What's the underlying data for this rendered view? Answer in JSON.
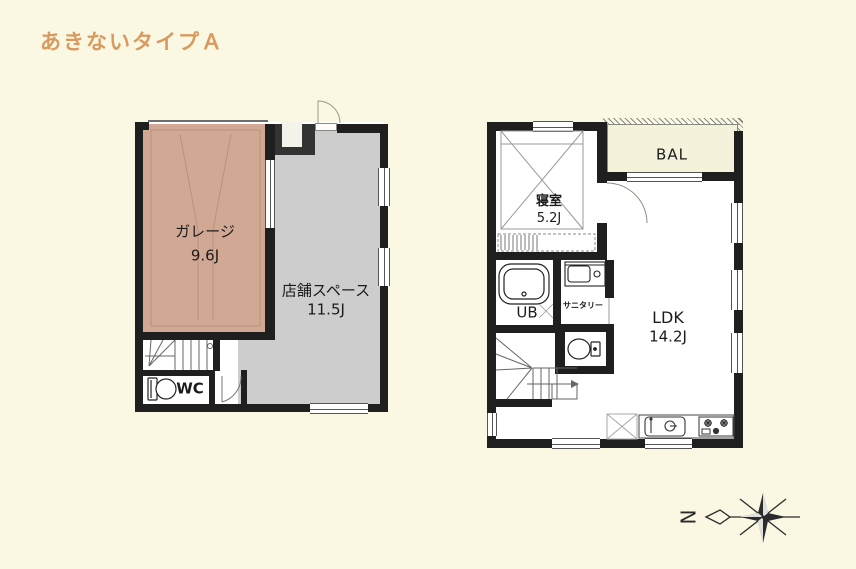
{
  "page": {
    "title": "あきないタイプＡ"
  },
  "colors": {
    "background": "#FAF8E3",
    "title": "#D99A5F",
    "wall": "#1F1F1F",
    "garage_fill": "#D1A894",
    "shop_fill": "#CDCDCD",
    "balcony_fill": "#F4F2DB"
  },
  "floor1": {
    "garage": {
      "name": "ガレージ",
      "area": "9.6J"
    },
    "shop": {
      "name": "店舗スペース",
      "area": "11.5J"
    },
    "wc": {
      "label": "WC"
    }
  },
  "floor2": {
    "bedroom": {
      "name": "寝室",
      "area": "5.2J"
    },
    "balcony": {
      "label": "BAL"
    },
    "bath": {
      "label": "UB"
    },
    "sanitary": {
      "label": "サニタリー"
    },
    "ldk": {
      "name": "LDK",
      "area": "14.2J"
    }
  },
  "compass": {
    "north_label": "N"
  }
}
